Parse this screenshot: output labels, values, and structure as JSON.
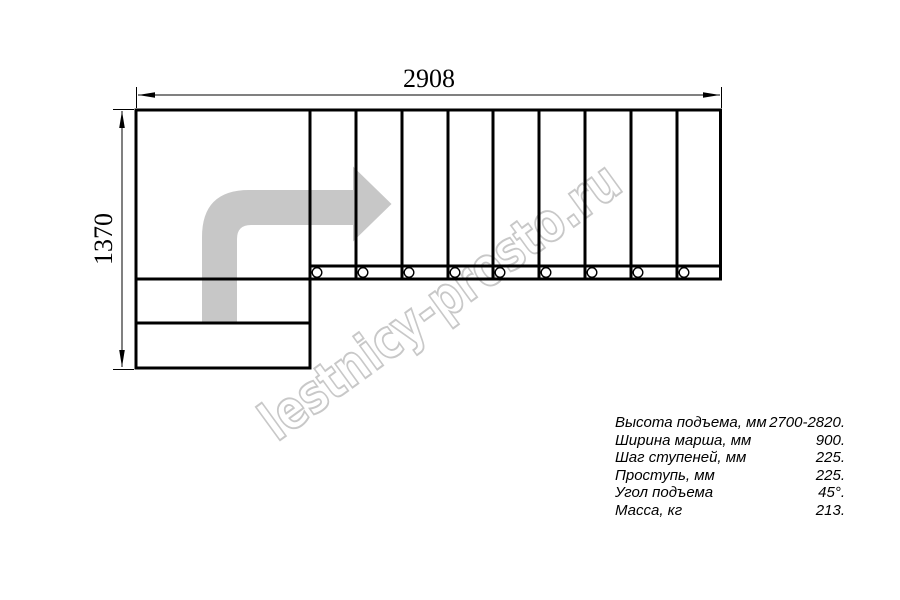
{
  "drawing": {
    "width_label": "2908",
    "height_label": "1370",
    "watermark": "lestnicy-prosto.ru",
    "colors": {
      "line": "#000000",
      "arrow": "#c7c7c7",
      "watermark_stroke": "#c8c8c8"
    }
  },
  "specs": {
    "rows": [
      {
        "label": "Высота подъема, мм",
        "value": "2700-2820."
      },
      {
        "label": "Ширина марша, мм",
        "value": "900."
      },
      {
        "label": "Шаг ступеней, мм",
        "value": "225."
      },
      {
        "label": "Проступь, мм",
        "value": "225."
      },
      {
        "label": "Угол подъема",
        "value": "45°."
      },
      {
        "label": "Масса, кг",
        "value": "213."
      }
    ]
  }
}
